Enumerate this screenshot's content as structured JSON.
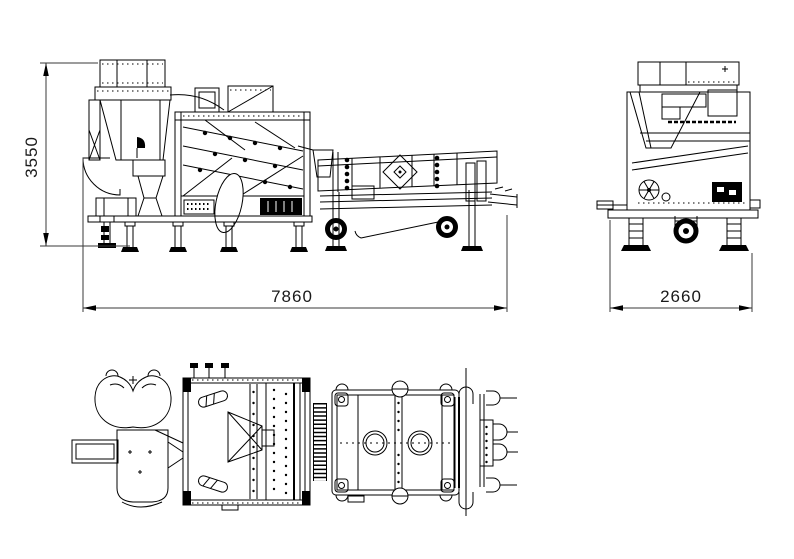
{
  "page": {
    "background_color": "#ffffff",
    "line_color": "#000000"
  },
  "drawing": {
    "type": "technical-three-view-machine-drawing",
    "dimensions": {
      "height": {
        "value": "3550",
        "orientation": "vertical"
      },
      "length": {
        "value": "7860",
        "orientation": "horizontal"
      },
      "width": {
        "value": "2660",
        "orientation": "horizontal"
      }
    }
  }
}
